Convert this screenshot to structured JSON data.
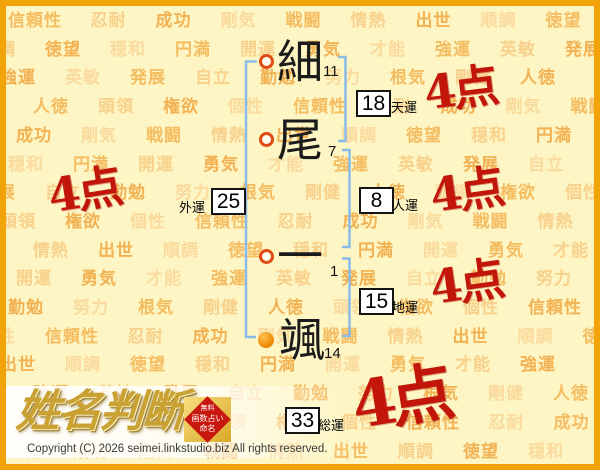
{
  "page": {
    "logo_text": "姓名判断",
    "copyright": "Copyright (C) 2026 seimei.linkstudio.biz All rights reserved."
  },
  "stamp": {
    "lines": [
      "無料",
      "画数占い",
      "命名"
    ]
  },
  "name": {
    "characters": [
      {
        "char": "細",
        "strokes": "11",
        "marker": "hollow"
      },
      {
        "char": "尾",
        "strokes": "7",
        "marker": "hollow"
      },
      {
        "char": "一",
        "strokes": "1",
        "marker": "hollow"
      },
      {
        "char": "颯",
        "strokes": "14",
        "marker": "filled"
      }
    ]
  },
  "fortunes": [
    {
      "id": "ten",
      "label": "天運",
      "value": "18",
      "score": "4点"
    },
    {
      "id": "jin",
      "label": "人運",
      "value": "8",
      "score": "4点"
    },
    {
      "id": "gai",
      "label": "外運",
      "value": "25",
      "score": "4点"
    },
    {
      "id": "chi",
      "label": "地運",
      "value": "15",
      "score": "4点"
    },
    {
      "id": "sou",
      "label": "総運",
      "value": "33",
      "score": "4点"
    }
  ],
  "watermark": {
    "words": [
      "信頼性",
      "忍耐",
      "成功",
      "剛気",
      "戦闘",
      "情熱",
      "出世",
      "順調",
      "徳望",
      "穏和",
      "円満",
      "開運",
      "勇気",
      "才能",
      "強運",
      "英敏",
      "発展",
      "自立",
      "勤勉",
      "努力",
      "根気",
      "剛健",
      "人徳",
      "頭領",
      "権欲",
      "個性"
    ]
  },
  "colors": {
    "background": "#fdf5c3",
    "frame_border": "#f2a30a",
    "score_red": "#c2160b",
    "bracket_blue": "#8abbe8",
    "marker_ring": "#e04a14",
    "marker_fill": "#ee8500",
    "watermark_shades": [
      "#f5bd62",
      "#f8d18c",
      "#f2b254",
      "#fada9d"
    ]
  }
}
